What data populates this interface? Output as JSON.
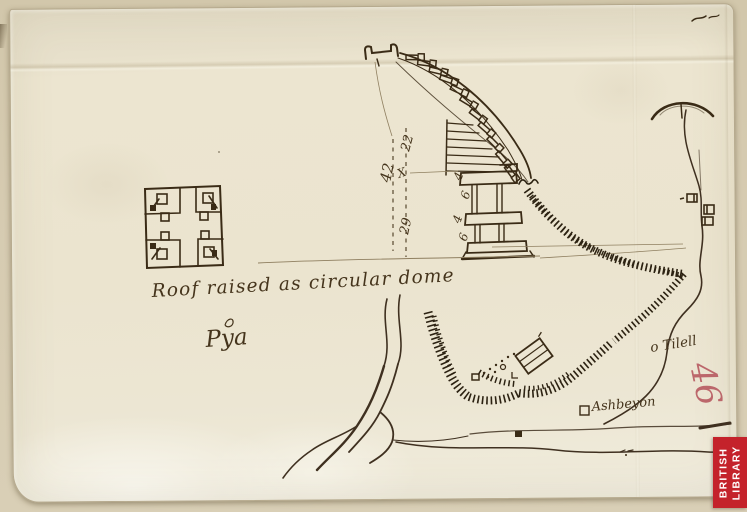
{
  "annotations": {
    "roof_note": "Roof raised as circular dome",
    "pya_label": "Pya",
    "tilell_label": "o Tilell",
    "village_label": "Ashbeyon",
    "folio_number": "46"
  },
  "measurements": {
    "left_height": "42",
    "upper_right": "22",
    "lower_right": "29",
    "cross_mark": "X",
    "col_marks": [
      "4",
      "6",
      "4",
      "6"
    ]
  },
  "stamp": {
    "line1": "BRITISH",
    "line2": "LIBRARY"
  },
  "colors": {
    "ink": "#3a2b16",
    "ink_text": "#45341c",
    "hatch": "#2c2212",
    "faint": "#8f7f60",
    "paper": "#ebe4cf",
    "mount": "#d6cbb1",
    "stamp_red": "#c4222b",
    "folio_red": "#b4525a"
  }
}
